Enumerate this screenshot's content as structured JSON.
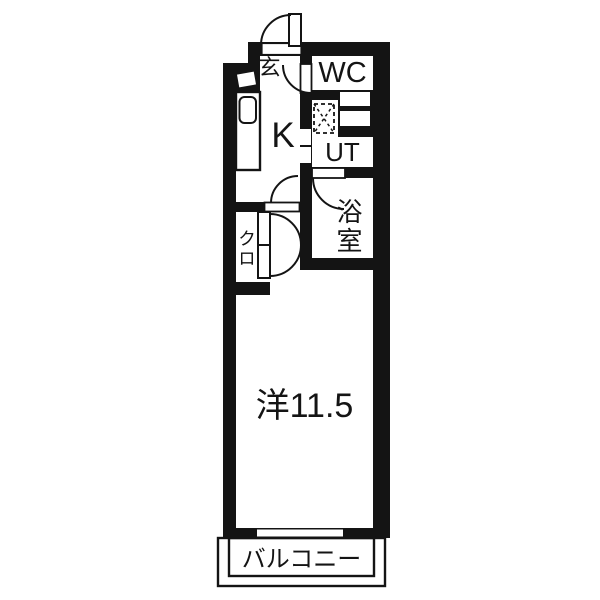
{
  "floorplan": {
    "rooms": [
      {
        "id": "entrance",
        "label": "玄"
      },
      {
        "id": "wc",
        "label": "WC"
      },
      {
        "id": "kitchen",
        "label": "K"
      },
      {
        "id": "utility",
        "label": "UT"
      },
      {
        "id": "bathroom",
        "label": "浴室"
      },
      {
        "id": "closet",
        "label": "クロ"
      },
      {
        "id": "western_room",
        "label": "洋11.5"
      },
      {
        "id": "balcony",
        "label": "バルコニー"
      }
    ],
    "icons": [
      "washing-machine-icon",
      "kitchen-sink-icon",
      "shoe-cabinet-icon",
      "door-swing-arc",
      "sliding-window"
    ],
    "colors": {
      "wall": "#141414",
      "floor": "#ffffff"
    }
  }
}
